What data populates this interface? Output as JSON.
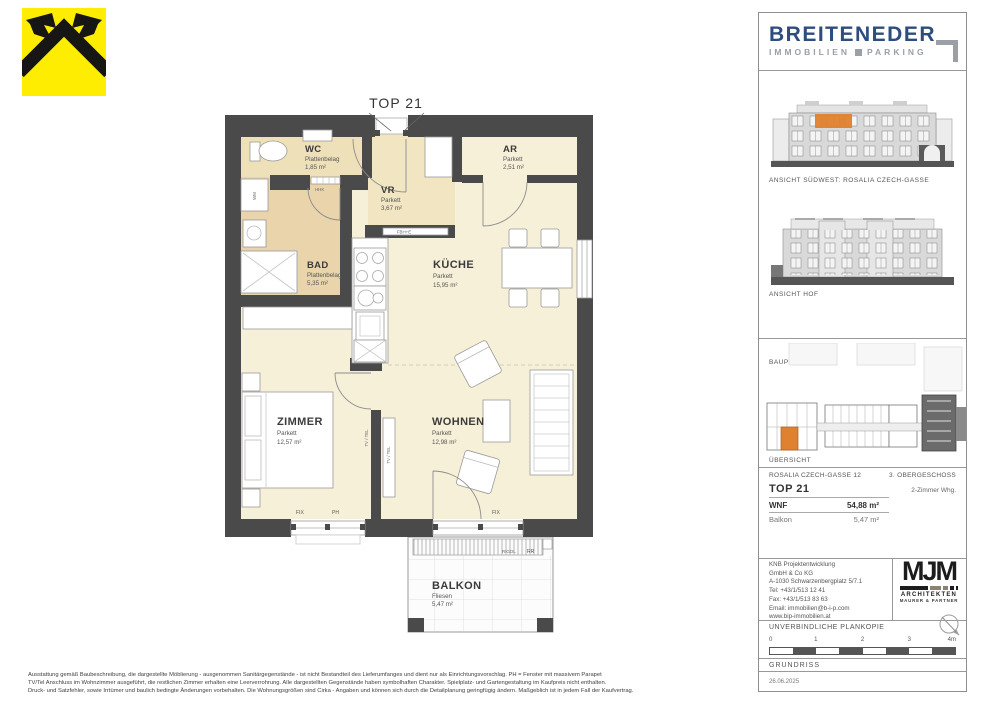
{
  "colors": {
    "wall": "#4A4A4A",
    "orange": "#E0812F",
    "brand_blue": "#2D4D7E",
    "brand_gray": "#9AA0A6",
    "cream": "#F7F0D8",
    "tan": "#EFE1BA",
    "tan_dark": "#E9D4AB"
  },
  "brand": {
    "name": "BREITENEDER",
    "sub_left": "IMMOBILIEN",
    "sub_right": "PARKING"
  },
  "plan": {
    "title": "TOP 21",
    "rooms": {
      "wc": {
        "name": "WC",
        "floor": "Plattenbelag",
        "area": "1,85 m²"
      },
      "vr": {
        "name": "VR",
        "floor": "Parkett",
        "area": "3,67 m²"
      },
      "ar": {
        "name": "AR",
        "floor": "Parkett",
        "area": "2,51 m²"
      },
      "bad": {
        "name": "BAD",
        "floor": "Plattenbelag",
        "area": "5,35 m²"
      },
      "kueche": {
        "name": "KÜCHE",
        "floor": "Parkett",
        "area": "15,95 m²"
      },
      "zimmer": {
        "name": "ZIMMER",
        "floor": "Parkett",
        "area": "12,57 m²"
      },
      "wohnen": {
        "name": "WOHNEN",
        "floor": "Parkett",
        "area": "12,98 m²"
      },
      "balkon": {
        "name": "BALKON",
        "floor": "Fliesen",
        "area": "5,47 m²"
      }
    },
    "labels": {
      "fix": "FIX",
      "ph": "PH",
      "hhk": "HHK",
      "fbhe": "FBH+E",
      "wm": "WM",
      "tvtel": "TV / TEL",
      "rigol": "RIGOL",
      "rr": "RR"
    }
  },
  "sidebar": {
    "elevation1_caption": "ANSICHT SÜDWEST: ROSALIA CZECH-GASSE",
    "elevation2_caption": "ANSICHT HOF",
    "bauplatz": "BAUPLATZ  A",
    "overview_caption": "ÜBERSICHT",
    "address": "ROSALIA CZECH-GASSE 12",
    "floor_level": "3. OBERGESCHOSS",
    "unit": "TOP 21",
    "unit_type": "2-Zimmer Whg.",
    "wnf_label": "WNF",
    "wnf_value": "54,88 m²",
    "balkon_label": "Balkon",
    "balkon_value": "5,47 m²",
    "contact": [
      "KNB Projektentwicklung",
      "GmbH & Co KG",
      "A-1030 Schwarzenbergplatz 5/7.1",
      "Tel: +43/1/513 12 41",
      "Fax: +43/1/513 83 63",
      "Email: immobilien@b-i-p.com",
      "www.bip-immobilien.at"
    ],
    "architects": {
      "logo": "MJM",
      "line1": "ARCHITEKTEN",
      "line2": "MAURER & PARTNER"
    },
    "plankopie": "UNVERBINDLICHE PLANKOPIE",
    "scale_ticks": [
      "0",
      "1",
      "2",
      "3",
      "4m"
    ],
    "drawing_type": "GRUNDRISS",
    "date": "26.06.2025"
  },
  "disclaimer": {
    "line1": "Ausstattung gemäß Baubeschreibung, die dargestellte Möblierung - ausgenommen Sanitärgegenstände - ist nicht Bestandteil des Lieferumfanges und dient nur als Einrichtungsvorschlag. PH = Fenster mit massivem Parapet",
    "line2": "TV/Tel Anschluss im Wohnzimmer ausgeführt, die restlichen Zimmer erhalten eine Leerverrohrung. Alle dargestellten Gegenstände haben symbolhaften Charakter. Spielplatz- und Gartengestaltung im Kaufpreis nicht enthalten.",
    "line3": "Druck- und Satzfehler, sowie Irrtümer und baulich bedingte Änderungen vorbehalten. Die Wohnungsgrößen sind Cirka - Angaben und können sich durch die Detailplanung geringfügig ändern. Maßgeblich ist in jedem Fall der Kaufvertrag."
  }
}
